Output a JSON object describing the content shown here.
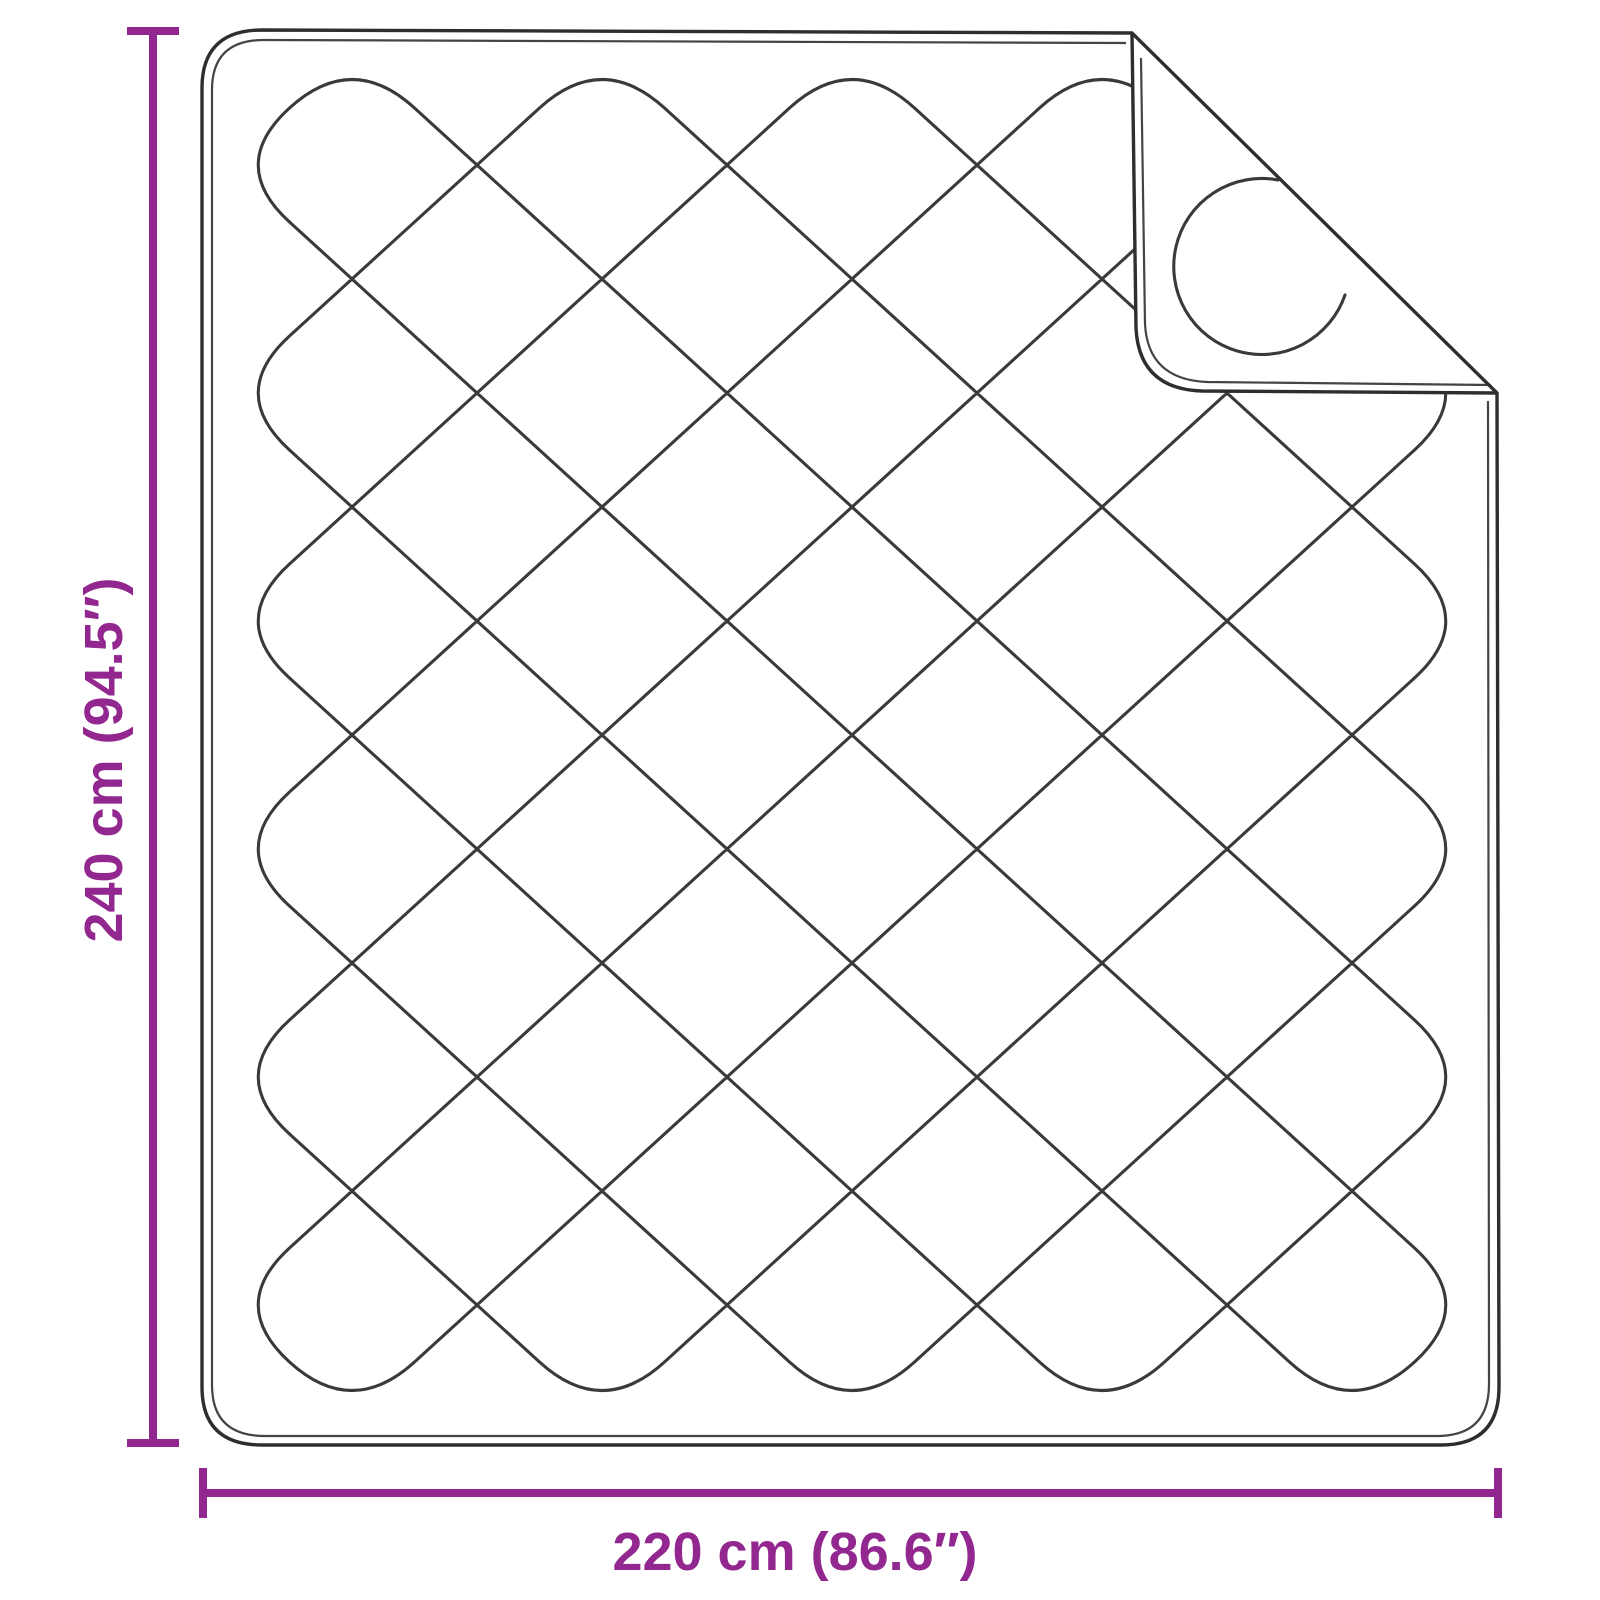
{
  "figure": {
    "title": "Quilted blanket dimension diagram",
    "subject": "quilted blanket with folded-over top-right corner",
    "background_color": "#ffffff",
    "line_color": "#3a3a3a",
    "accent_color": "#92278F"
  },
  "dimensions": {
    "height": {
      "label": "240 cm (94.5″)",
      "value_cm": 240,
      "value_inch": 94.5
    },
    "width": {
      "label": "220 cm (86.6″)",
      "value_cm": 220,
      "value_inch": 86.6
    }
  }
}
